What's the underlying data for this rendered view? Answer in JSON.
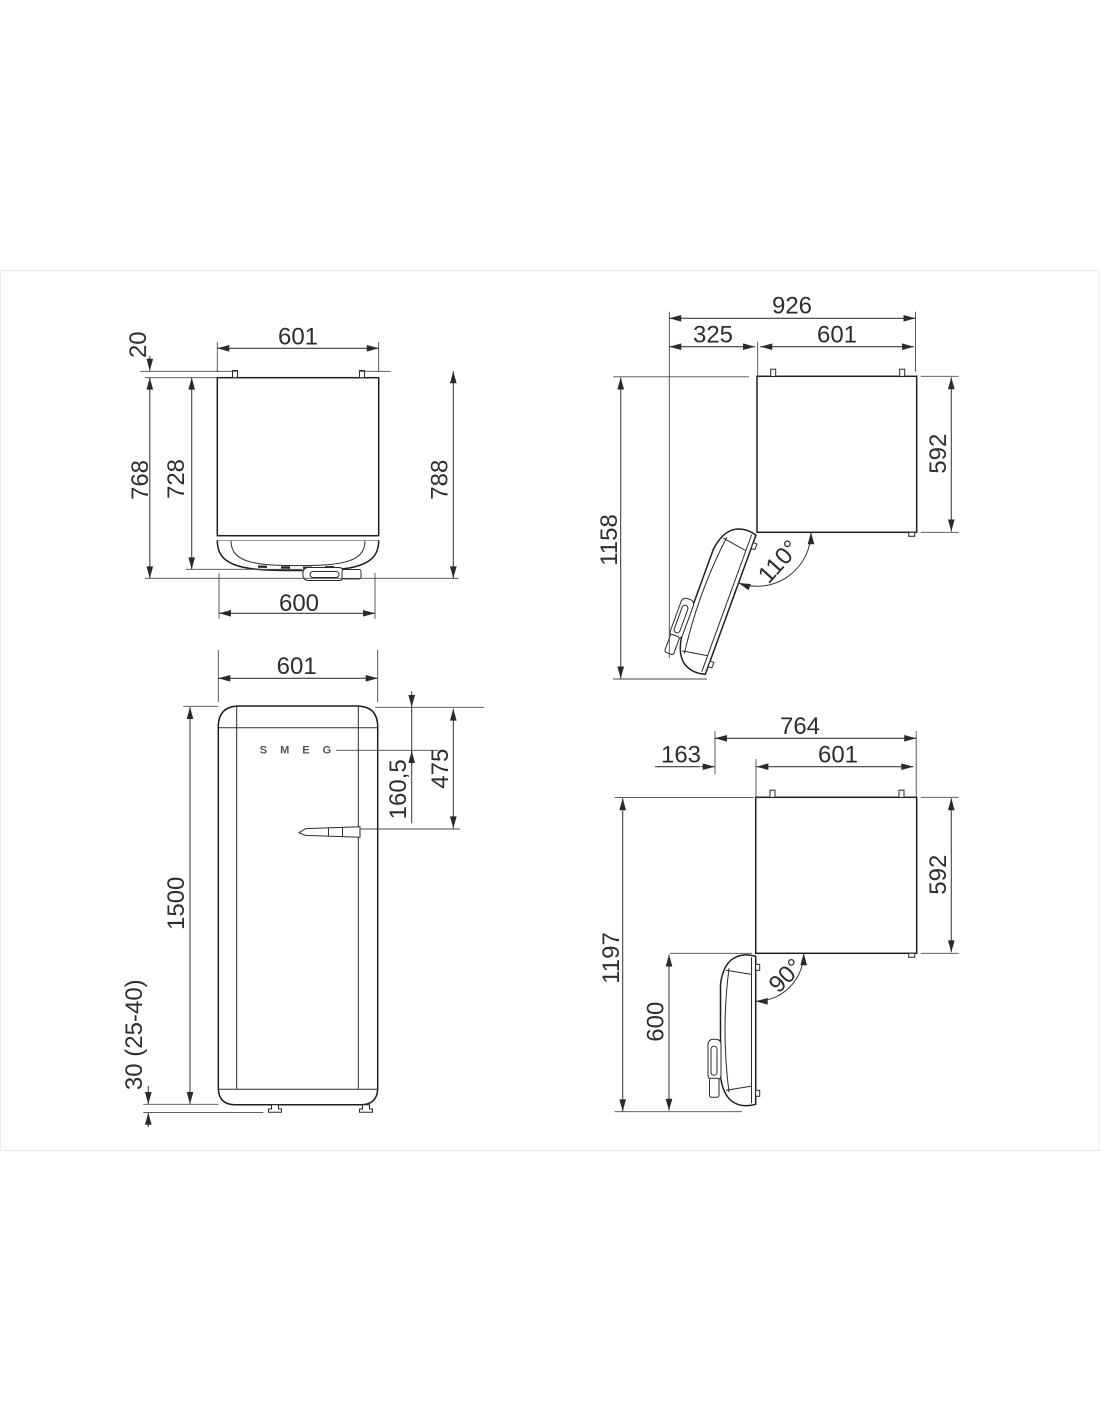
{
  "page": {
    "background": "#ffffff",
    "card_border_color": "#ececec"
  },
  "views": {
    "top_closed": {
      "title": "top view door closed",
      "width_top": "601",
      "hinge_protrusion": "20",
      "depth_with_door": "768",
      "depth_without_door": "728",
      "depth_total": "788",
      "width_door": "600"
    },
    "top_open_110": {
      "title": "top view door open 110",
      "total_width": "926",
      "door_swing": "325",
      "width": "601",
      "total_depth": "1158",
      "cabinet_depth": "592",
      "angle": "110°"
    },
    "front": {
      "title": "front view",
      "width": "601",
      "logo_offset": "160,5",
      "handle_offset": "475",
      "height": "1500",
      "feet_height": "30 (25-40)",
      "logo": "SMEG"
    },
    "top_open_90": {
      "title": "top view door open 90",
      "total_width": "764",
      "door_depth": "163",
      "width": "601",
      "total_depth": "1197",
      "cabinet_depth": "592",
      "door_width": "600",
      "angle": "90°"
    }
  }
}
